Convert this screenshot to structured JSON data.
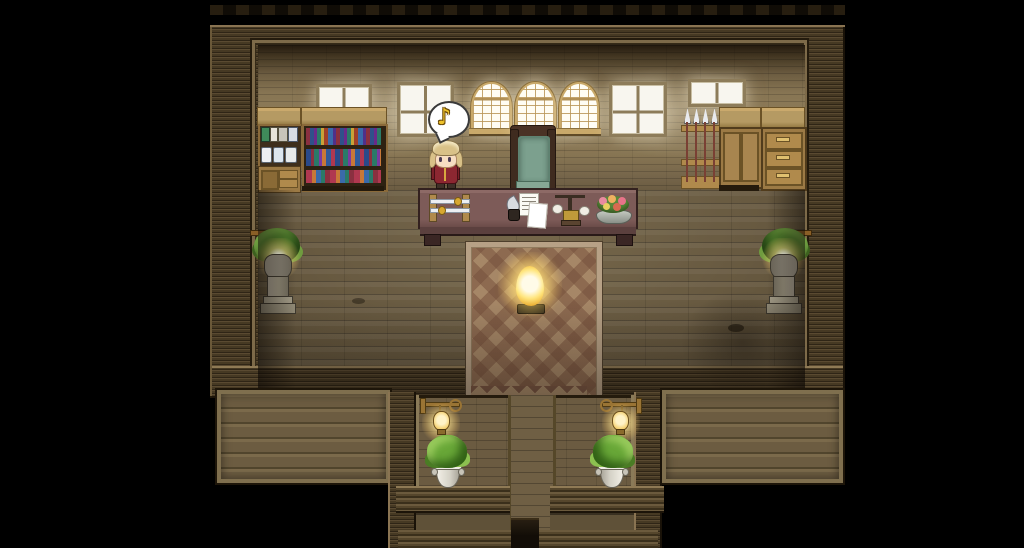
{
  "scene": {
    "title": "Wooden study hall - top-down RPG interior",
    "style": "pixel-art RPG (RPG Maker style) room with wooden walls, plank floor and south staircase",
    "background_color": "#000000"
  },
  "balloon": {
    "icon": "music-note",
    "glyph": "♪",
    "bubble_color": "#ffffff",
    "note_color": "#eec22b"
  },
  "character": {
    "name": "blonde-villager",
    "facing": "down",
    "hair_color": "#d9c188",
    "coat_color": "#8c2731",
    "state": "standing on floor left of the desk, music balloon above head"
  },
  "objects": {
    "top_wall_row": [
      {
        "name": "jar-shelf",
        "desc": "hutch with canisters and jars"
      },
      {
        "name": "bookshelf",
        "desc": "two rows of colorful books"
      },
      {
        "name": "plain-window-small-left",
        "desc": "white glowing window"
      },
      {
        "name": "plain-window-tall-left",
        "desc": "tall white glowing window"
      },
      {
        "name": "arched-window-1",
        "desc": "gold framed arched window"
      },
      {
        "name": "arched-window-2",
        "desc": "gold framed arched window"
      },
      {
        "name": "arched-window-3",
        "desc": "gold framed arched window"
      },
      {
        "name": "plain-window-tall-right",
        "desc": "tall white glowing window"
      },
      {
        "name": "plain-window-small-right",
        "desc": "white glowing window"
      },
      {
        "name": "spear-rack",
        "desc": "four spears with silver tips"
      },
      {
        "name": "double-door-cabinet",
        "desc": "wooden cabinet"
      },
      {
        "name": "drawer-dresser",
        "desc": "three drawer dresser"
      }
    ],
    "center": [
      {
        "name": "office-chair",
        "desc": "dark wood chair with green cushion"
      },
      {
        "name": "desk",
        "desc": "long maroon desk"
      },
      {
        "name": "sword-display",
        "desc": "two white swords on stand"
      },
      {
        "name": "documents",
        "desc": "note, paper, quill and ink"
      },
      {
        "name": "balance-scale",
        "desc": "scale with two white pans"
      },
      {
        "name": "flower-bowl",
        "desc": "bowl of pink and orange flowers"
      },
      {
        "name": "diamond-carpet",
        "desc": "brown argyle carpet running south"
      },
      {
        "name": "glowing-brazier",
        "desc": "golden glowing object on carpet"
      }
    ],
    "side_decor": [
      {
        "name": "pedestal-lamp-left",
        "desc": "stone pedestal, plant and glowing lamp"
      },
      {
        "name": "pedestal-lamp-right",
        "desc": "stone pedestal, plant and glowing lamp"
      }
    ],
    "south_terrace": [
      {
        "name": "wall-lantern-left",
        "desc": "brass bracket lantern"
      },
      {
        "name": "wall-lantern-right",
        "desc": "brass bracket lantern"
      },
      {
        "name": "potted-plant-left",
        "desc": "green plant in white vase"
      },
      {
        "name": "potted-plant-right",
        "desc": "green plant in white vase"
      },
      {
        "name": "stair-passage",
        "desc": "central stairs descending into darkness"
      }
    ]
  },
  "colors": {
    "outer_wall": "#463923",
    "inner_wall": "#877553",
    "floor": "#6b5d42",
    "desk_top": "#7d5b58",
    "carpet_light": "#a08260",
    "carpet_dark": "#78523e",
    "chair_cushion": "#7ca08e",
    "window_glow": "#fff6de",
    "lamp_glow": "#ffe28c",
    "arch_frame": "#c9a96a"
  }
}
